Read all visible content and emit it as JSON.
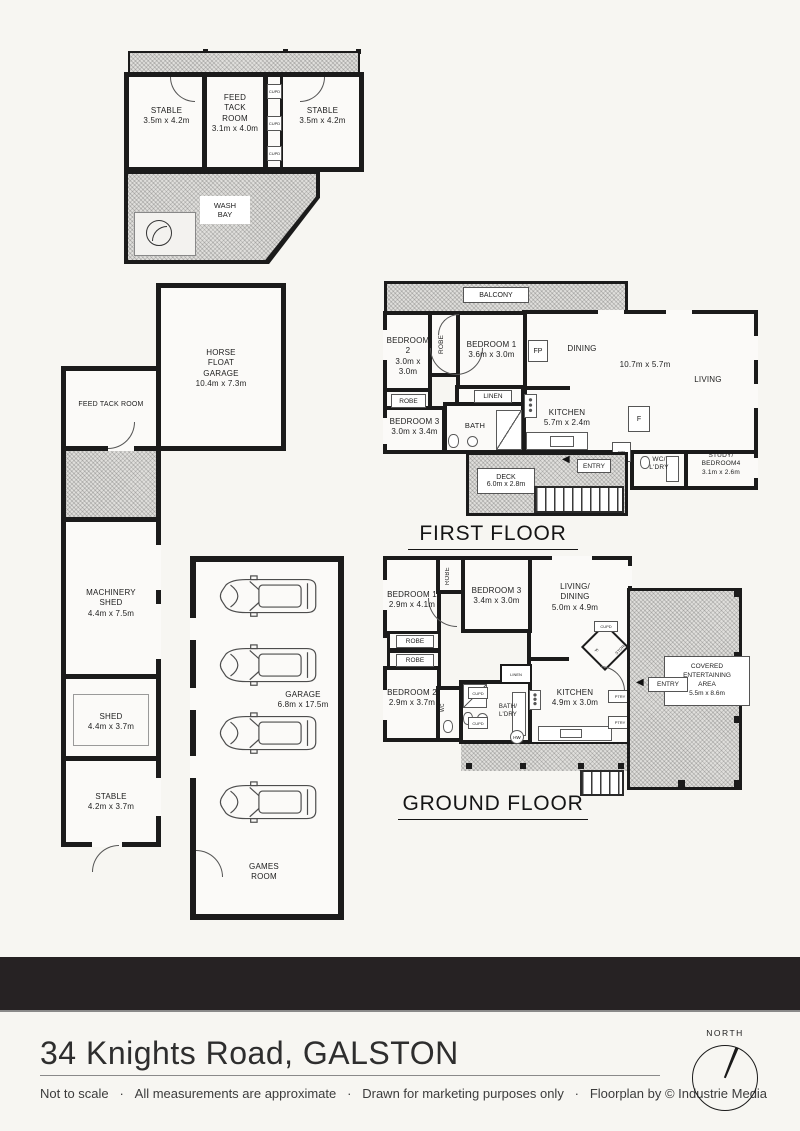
{
  "colors": {
    "wall": "#1b1b1b",
    "page_bg": "#f7f6f2",
    "bar_bg": "#262223",
    "hatch": "#d9d8d5"
  },
  "stable_block": {
    "stable_left": "STABLE\n3.5m x 4.2m",
    "feed_tack_room": "FEED\nTACK\nROOM\n3.1m x 4.0m",
    "stable_right": "STABLE\n3.5m x 4.2m",
    "cupd1": "CUPD",
    "cupd2": "CUPD",
    "cupd3": "CUPD",
    "wash_bay": "WASH\nBAY"
  },
  "horse_garage": {
    "horse_float_garage": "HORSE\nFLOAT\nGARAGE\n10.4m x 7.3m",
    "feed_tack_room": "FEED TACK ROOM"
  },
  "shed_block": {
    "machinery_shed": "MACHINERY\nSHED\n4.4m x 7.5m",
    "shed": "SHED\n4.4m x 3.7m",
    "stable": "STABLE\n4.2m x 3.7m"
  },
  "garage_block": {
    "garage": "GARAGE\n6.8m x 17.5m",
    "games_room": "GAMES\nROOM"
  },
  "first_floor": {
    "title": "FIRST FLOOR",
    "balcony": "BALCONY",
    "bedroom2": "BEDROOM 2\n3.0m x 3.0m",
    "robe_vertical": "ROBE",
    "bedroom1": "BEDROOM 1\n3.6m x 3.0m",
    "robe": "ROBE",
    "bedroom3": "BEDROOM 3\n3.0m x 3.4m",
    "linen": "LINEN",
    "bath": "BATH",
    "kitchen": "KITCHEN\n5.7m x 2.4m",
    "dining": "DINING",
    "living_dims": "10.7m x 5.7m",
    "living": "LIVING",
    "fireplace": "FP",
    "fridge": "F",
    "wb": "WB",
    "wc_laundry": "WC/\nL'DRY",
    "study_bed4": "STUDY/\nBEDROOM4\n3.1m x 2.6m",
    "entry": "ENTRY",
    "deck": "DECK\n6.0m x 2.8m"
  },
  "ground_floor": {
    "title": "GROUND FLOOR",
    "bedroom1": "BEDROOM 1\n2.9m x 4.1m",
    "robe_vertical": "ROBE",
    "bedroom3": "BEDROOM 3\n3.4m x 3.0m",
    "living_dining": "LIVING/\nDINING\n5.0m x 4.9m",
    "robe1": "ROBE",
    "robe2": "ROBE",
    "bedroom2": "BEDROOM 2\n2.9m x 3.7m",
    "wc": "WC",
    "cupd1": "CUPD",
    "cupd2": "CUPD",
    "bath_laundry": "BATH/\nL'DRY",
    "linen": "LINEN",
    "kitchen": "KITCHEN\n4.9m x 3.0m",
    "pantry_cupd": "CUPD",
    "store": "STORE",
    "fridge": "F",
    "ptry1": "PTRY",
    "ptry2": "PTRY",
    "hw": "HW",
    "entry": "ENTRY",
    "covered_area": "COVERED\nENTERTAINING\nAREA\n5.5m x 8.6m"
  },
  "footer": {
    "address": "34 Knights Road, GALSTON",
    "disclaimer": "Not to scale   ·   All measurements are approximate   ·   Drawn for marketing purposes only   ·   Floorplan by © Industrie Media",
    "north": "NORTH"
  }
}
